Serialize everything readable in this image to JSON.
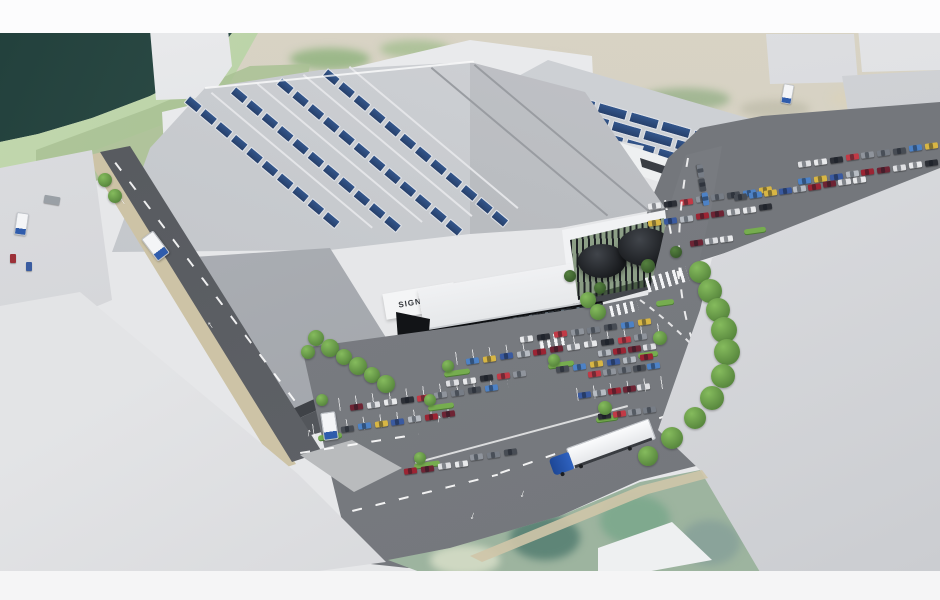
{
  "scene": {
    "description": "Aerial 3D architectural render of a logistics and retail park with solar roofs, car parking and access roads beside a waterway",
    "main_warehouse": {
      "signage_label": "SIGNAGE",
      "roof_color": "#c7cace",
      "solar_panel_color": "#2d4f86",
      "solar_rows": 4
    },
    "second_warehouse": {
      "solar_rows": 3,
      "sign_colors": [
        "#e8b62a",
        "#26292e"
      ]
    },
    "retail_building": {
      "facade_color": "#23262b"
    },
    "water_color": "#2e4a45",
    "asphalt_color": "#75787d",
    "greenery_color": "#85bb5d",
    "solar": {
      "main_rows": [
        {
          "x": 190,
          "y": 95,
          "angle": 40,
          "n": 10
        },
        {
          "x": 236,
          "y": 86,
          "angle": 40,
          "n": 11
        },
        {
          "x": 282,
          "y": 77,
          "angle": 40,
          "n": 12
        },
        {
          "x": 328,
          "y": 68,
          "angle": 40,
          "n": 12
        }
      ],
      "wh2_rows": [
        {
          "x": 536,
          "y": 84,
          "angle": 16,
          "n": 8,
          "lg": true
        },
        {
          "x": 550,
          "y": 102,
          "angle": 16,
          "n": 8,
          "lg": true
        },
        {
          "x": 564,
          "y": 120,
          "angle": 16,
          "n": 7,
          "lg": true
        }
      ]
    },
    "cars": {
      "palette": [
        "#e9eaec",
        "#b7bcc3",
        "#474c54",
        "#2c2f36",
        "#9c2433",
        "#4d82c6",
        "#c23a46",
        "#6e2434",
        "#d8b644",
        "#8f949c",
        "#dfe0e3",
        "#3a5aa0",
        "#777d86"
      ],
      "rows": [
        {
          "x": 520,
          "y": 336,
          "n": 8,
          "angle": -8,
          "gap": 17
        },
        {
          "x": 466,
          "y": 358,
          "n": 11,
          "angle": -8,
          "gap": 17
        },
        {
          "x": 446,
          "y": 380,
          "n": 5,
          "angle": -8,
          "gap": 17
        },
        {
          "x": 556,
          "y": 366,
          "n": 6,
          "angle": -8,
          "gap": 17
        },
        {
          "x": 350,
          "y": 404,
          "n": 9,
          "angle": -8,
          "gap": 17
        },
        {
          "x": 324,
          "y": 428,
          "n": 8,
          "angle": -8,
          "gap": 17
        },
        {
          "x": 404,
          "y": 468,
          "n": 4,
          "angle": -8,
          "gap": 17
        },
        {
          "x": 470,
          "y": 454,
          "n": 3,
          "angle": -8,
          "gap": 17
        },
        {
          "x": 598,
          "y": 350,
          "n": 4,
          "angle": -8,
          "gap": 15
        },
        {
          "x": 588,
          "y": 371,
          "n": 5,
          "angle": -8,
          "gap": 15
        },
        {
          "x": 578,
          "y": 392,
          "n": 5,
          "angle": -8,
          "gap": 15
        },
        {
          "x": 598,
          "y": 413,
          "n": 4,
          "angle": -8,
          "gap": 15
        },
        {
          "x": 648,
          "y": 220,
          "n": 8,
          "angle": -8,
          "gap": 16
        },
        {
          "x": 648,
          "y": 203,
          "n": 8,
          "angle": -8,
          "gap": 16
        },
        {
          "x": 798,
          "y": 178,
          "n": 9,
          "angle": -8,
          "gap": 16
        },
        {
          "x": 798,
          "y": 161,
          "n": 9,
          "angle": -8,
          "gap": 16
        },
        {
          "x": 734,
          "y": 194,
          "n": 9,
          "angle": -8,
          "gap": 15
        },
        {
          "x": 690,
          "y": 240,
          "n": 3,
          "angle": -8,
          "gap": 15
        },
        {
          "x": 694,
          "y": 168,
          "n": 3,
          "angle": 80,
          "gap": 14
        }
      ]
    },
    "vehicles": {
      "semi_truck": {
        "cab_color": "#2a56aa",
        "trailer_color": "#f2f3f5"
      },
      "box_trucks": [
        {
          "x": 148,
          "y": 232,
          "angle": -37,
          "s": 1
        },
        {
          "x": 322,
          "y": 412,
          "angle": -8,
          "s": 1
        },
        {
          "x": 780,
          "y": 80,
          "angle": 10,
          "s": 0.7
        },
        {
          "x": 14,
          "y": 210,
          "angle": 8,
          "s": 0.8
        }
      ]
    },
    "landscape": {
      "trees": [
        {
          "x": 700,
          "y": 272,
          "r": 11
        },
        {
          "x": 710,
          "y": 291,
          "r": 12
        },
        {
          "x": 718,
          "y": 310,
          "r": 12
        },
        {
          "x": 724,
          "y": 330,
          "r": 13
        },
        {
          "x": 727,
          "y": 352,
          "r": 13
        },
        {
          "x": 723,
          "y": 376,
          "r": 12
        },
        {
          "x": 712,
          "y": 398,
          "r": 12
        },
        {
          "x": 695,
          "y": 418,
          "r": 11
        },
        {
          "x": 672,
          "y": 438,
          "r": 11
        },
        {
          "x": 648,
          "y": 456,
          "r": 10
        },
        {
          "x": 316,
          "y": 338,
          "r": 8
        },
        {
          "x": 330,
          "y": 348,
          "r": 9
        },
        {
          "x": 344,
          "y": 357,
          "r": 8
        },
        {
          "x": 358,
          "y": 366,
          "r": 9
        },
        {
          "x": 372,
          "y": 375,
          "r": 8
        },
        {
          "x": 386,
          "y": 384,
          "r": 9
        },
        {
          "x": 308,
          "y": 352,
          "r": 7
        },
        {
          "x": 588,
          "y": 300,
          "r": 8
        },
        {
          "x": 598,
          "y": 312,
          "r": 8
        },
        {
          "x": 448,
          "y": 366,
          "r": 6
        },
        {
          "x": 554,
          "y": 360,
          "r": 6
        },
        {
          "x": 430,
          "y": 400,
          "r": 6
        },
        {
          "x": 322,
          "y": 400,
          "r": 6
        },
        {
          "x": 420,
          "y": 458,
          "r": 6
        },
        {
          "x": 605,
          "y": 408,
          "r": 7
        },
        {
          "x": 660,
          "y": 338,
          "r": 7
        },
        {
          "x": 570,
          "y": 276,
          "r": 6,
          "d": 1
        },
        {
          "x": 600,
          "y": 288,
          "r": 6,
          "d": 1
        },
        {
          "x": 648,
          "y": 266,
          "r": 7,
          "d": 1
        },
        {
          "x": 676,
          "y": 252,
          "r": 6,
          "d": 1
        },
        {
          "x": 105,
          "y": 180,
          "r": 7
        },
        {
          "x": 115,
          "y": 196,
          "r": 7
        }
      ],
      "islands": [
        {
          "x": 444,
          "y": 370,
          "w": 26
        },
        {
          "x": 548,
          "y": 362,
          "w": 26
        },
        {
          "x": 428,
          "y": 404,
          "w": 26
        },
        {
          "x": 318,
          "y": 434,
          "w": 24
        },
        {
          "x": 414,
          "y": 462,
          "w": 26
        },
        {
          "x": 596,
          "y": 416,
          "w": 22
        },
        {
          "x": 638,
          "y": 352,
          "w": 20
        },
        {
          "x": 656,
          "y": 300,
          "w": 18
        },
        {
          "x": 744,
          "y": 228,
          "w": 22
        },
        {
          "x": 818,
          "y": 214,
          "w": 22
        }
      ]
    },
    "marks": {
      "arrow_glyph": "↑",
      "stalls": [
        {
          "x": 455,
          "y": 352,
          "w": 215
        },
        {
          "x": 338,
          "y": 398,
          "w": 170
        },
        {
          "x": 312,
          "y": 424,
          "w": 150
        },
        {
          "x": 576,
          "y": 388,
          "w": 90
        }
      ],
      "dashes": [
        {
          "x": 500,
          "y": 472,
          "w": 205,
          "r": -19
        },
        {
          "x": 352,
          "y": 510,
          "w": 150,
          "r": -14
        },
        {
          "x": 300,
          "y": 452,
          "w": 120,
          "r": -9
        },
        {
          "x": 666,
          "y": 200,
          "w": 80,
          "r": 80
        },
        {
          "x": 116,
          "y": 162,
          "w": 300,
          "r": 53
        }
      ],
      "lines": [
        {
          "x": 415,
          "y": 462,
          "w": 220,
          "r": -15
        },
        {
          "x": 205,
          "y": 87,
          "w": 270,
          "r": -5.6
        }
      ],
      "zebras": [
        {
          "x": 540,
          "y": 334,
          "w": 26,
          "h": 13,
          "r": -10
        },
        {
          "x": 646,
          "y": 272,
          "w": 42,
          "h": 15,
          "r": -16
        },
        {
          "x": 610,
          "y": 303,
          "w": 28,
          "h": 11,
          "r": -13
        }
      ],
      "arrows": [
        {
          "x": 306,
          "y": 428,
          "r": 12
        },
        {
          "x": 436,
          "y": 414,
          "r": 12
        },
        {
          "x": 520,
          "y": 488,
          "r": 198
        },
        {
          "x": 470,
          "y": 510,
          "r": 198
        },
        {
          "x": 668,
          "y": 430,
          "r": -24
        },
        {
          "x": 120,
          "y": 196,
          "r": -35
        },
        {
          "x": 208,
          "y": 320,
          "r": -35
        }
      ]
    }
  }
}
